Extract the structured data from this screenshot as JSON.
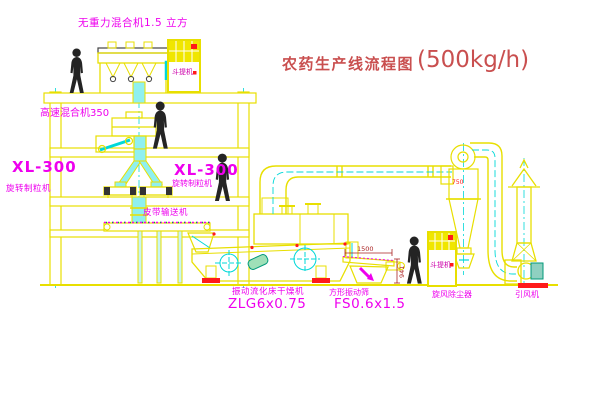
{
  "title": {
    "main": "农药生产线流程图",
    "capacity": "(500kg/h)"
  },
  "equipment_labels": {
    "gravity_mixer": "无重力混合机1.5 立方",
    "high_speed_mixer": "高速混合机350",
    "granulator_left": {
      "model": "XL-300",
      "name": "旋转制粒机"
    },
    "granulator_right": {
      "model": "XL-300",
      "name": "旋转制粒机"
    },
    "belt_conveyor": "皮带输送机",
    "fluid_bed_dryer": {
      "name": "振动流化床干燥机",
      "model": "ZLG6x0.75"
    },
    "vibrating_sieve": {
      "name": "方形振动筛",
      "model": "FS0.6x1.5"
    },
    "cyclone": "旋风除尘器",
    "induced_draft_fan": "引风机",
    "elevator_1": "斗提机",
    "elevator_2": "斗提机"
  },
  "annotations": {
    "cyclone_size": "750",
    "sieve_dim_width": "1500",
    "sieve_dim_height": "941"
  },
  "colors": {
    "line_yellow": "#e8df00",
    "chute_cyan": "#00d8d8",
    "label_magenta": "#ee00ee",
    "title_red": "#c94f4f",
    "marker_red": "#ff1a1a",
    "dimension_red": "#aa2222",
    "person_black": "#242424",
    "background": "#ffffff"
  }
}
